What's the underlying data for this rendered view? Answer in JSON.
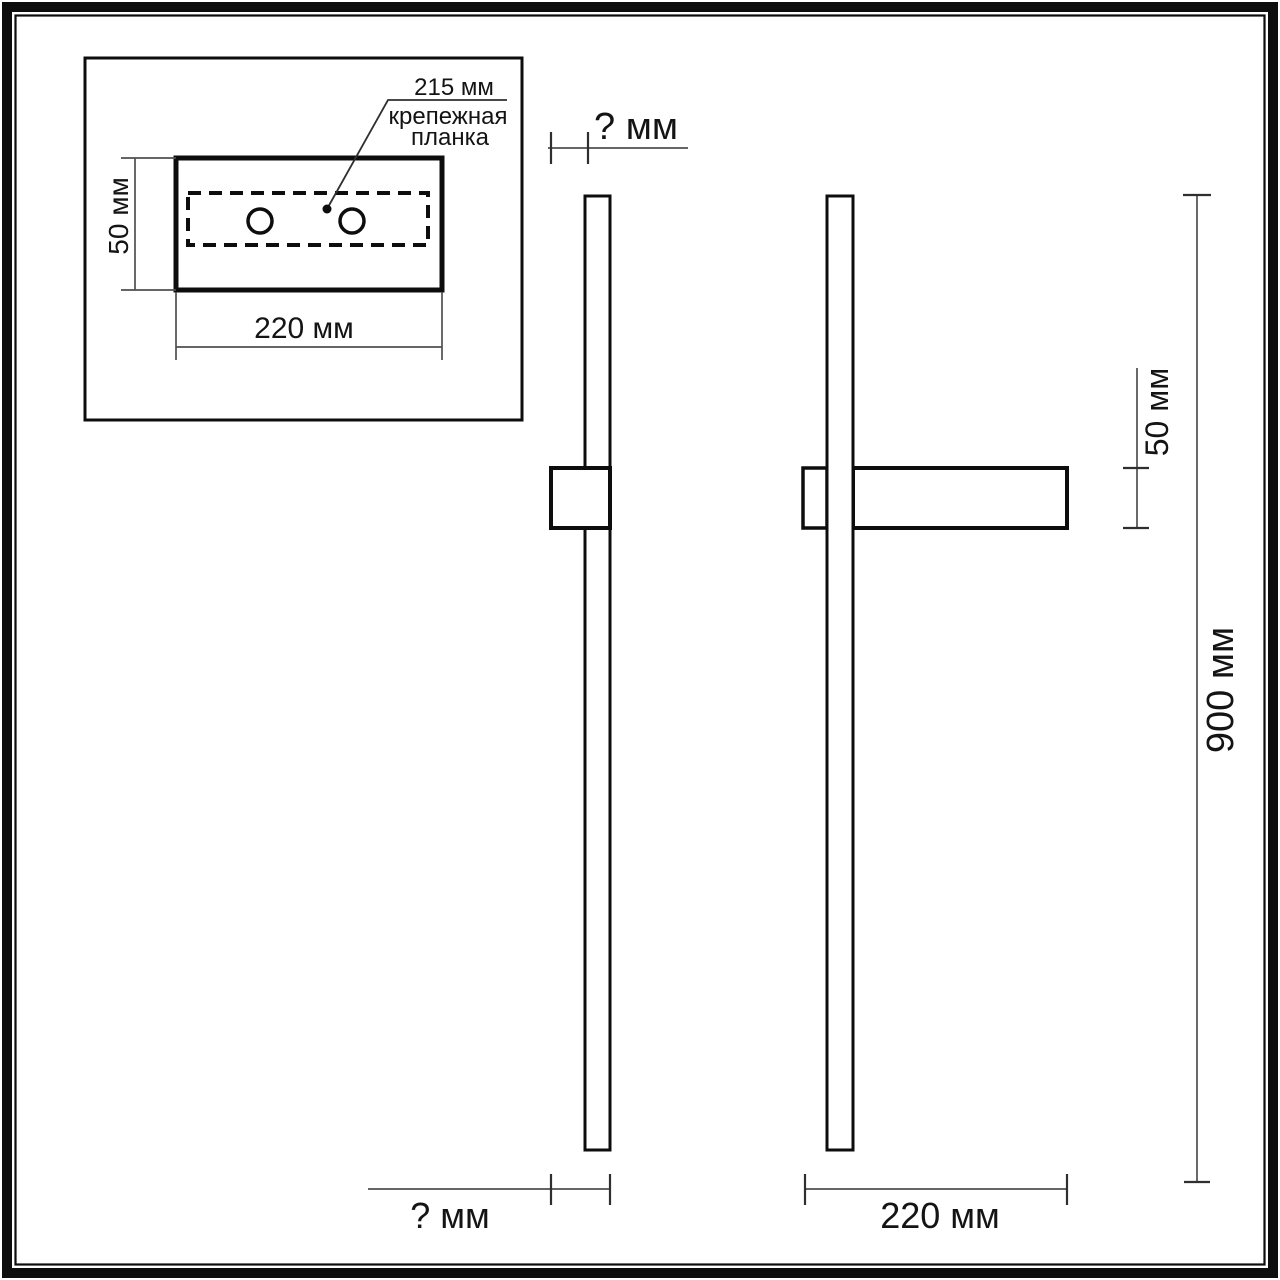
{
  "colors": {
    "outline": "#0d0d0d",
    "dimension": "#4f4f4f",
    "tick": "#2f2f2f",
    "text": "#141414",
    "background": "#ffffff"
  },
  "inset": {
    "hole_spacing_label": "215 мм",
    "mount_bar_name_line1": "крепежная",
    "mount_bar_name_line2": "планка",
    "plate_height_label": "50 мм",
    "plate_width_label": "220 мм"
  },
  "side_view": {
    "depth_label_top": "? мм",
    "depth_label_bottom": "? мм"
  },
  "front_view": {
    "plate_height_label": "50 мм",
    "total_height_label": "900 мм",
    "plate_width_label": "220 мм"
  }
}
